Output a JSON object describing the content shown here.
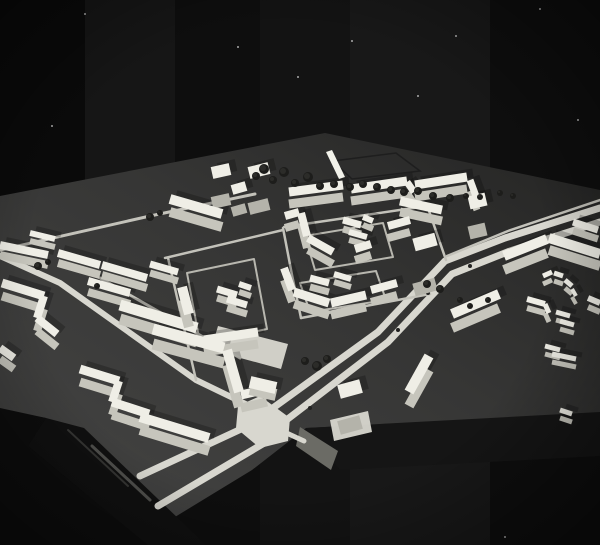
{
  "meta": {
    "alt": "Black-and-white photograph of a white architectural scale model of a residential district (urban planning maquette) on a dark baseboard against a black background"
  },
  "palette": {
    "background": "#0a0a0a",
    "board_light": "#454544",
    "board_mid": "#363635",
    "board_dark": "#242423",
    "board_face": "#151515",
    "board_face_lit": "#6b6b65",
    "roll_dark": "#101010",
    "road": "#d8d7cf",
    "path": "#c3c2ba",
    "loop": "#b8b7af",
    "building_top": "#efeee6",
    "building_face": "#c6c5bc",
    "building_face_tall": "#b4b3aa",
    "sliver": "#f2f2ea",
    "tree": "#1d1d1b",
    "tree_hi": "#3c3c38",
    "field_line": "#1e1e1e",
    "median_dot": "#222221"
  },
  "background": {
    "bands": [
      {
        "x": 0,
        "w": 85,
        "o": 0.0
      },
      {
        "x": 85,
        "w": 90,
        "o": 0.05
      },
      {
        "x": 175,
        "w": 85,
        "o": 0.02
      },
      {
        "x": 260,
        "w": 90,
        "o": 0.04
      },
      {
        "x": 350,
        "w": 140,
        "o": 0.06
      },
      {
        "x": 490,
        "w": 110,
        "o": 0.02
      }
    ],
    "specks": [
      [
        85,
        14
      ],
      [
        75,
        242
      ],
      [
        103,
        296
      ],
      [
        52,
        126
      ],
      [
        298,
        77
      ],
      [
        352,
        41
      ],
      [
        456,
        36
      ],
      [
        540,
        9
      ],
      [
        578,
        120
      ],
      [
        418,
        96
      ],
      [
        238,
        47
      ],
      [
        505,
        537
      ]
    ]
  },
  "board": {
    "outline": [
      [
        0,
        196
      ],
      [
        325,
        133
      ],
      [
        600,
        190
      ],
      [
        600,
        413
      ],
      [
        306,
        428
      ],
      [
        252,
        470
      ],
      [
        170,
        520
      ],
      [
        46,
        418
      ],
      [
        0,
        410
      ]
    ],
    "front_face": [
      [
        306,
        428
      ],
      [
        600,
        412
      ],
      [
        600,
        456
      ],
      [
        340,
        470
      ]
    ],
    "front_face_lit": [
      [
        300,
        427
      ],
      [
        338,
        451
      ],
      [
        331,
        470
      ],
      [
        296,
        446
      ]
    ],
    "corner_dark": [
      [
        0,
        408
      ],
      [
        46,
        418
      ],
      [
        28,
        446
      ],
      [
        148,
        545
      ],
      [
        0,
        545
      ]
    ],
    "roll": [
      [
        46,
        418
      ],
      [
        84,
        428
      ],
      [
        206,
        545
      ],
      [
        148,
        545
      ],
      [
        28,
        446
      ]
    ],
    "roll_highlights": [
      {
        "pts": [
          [
            92,
            446
          ],
          [
            150,
            500
          ]
        ],
        "w": 3,
        "o": 0.55,
        "c": "#83837d"
      },
      {
        "pts": [
          [
            68,
            430
          ],
          [
            128,
            486
          ]
        ],
        "w": 2,
        "o": 0.5,
        "c": "#5a5a55"
      }
    ],
    "field_outline": [
      [
        333,
        161
      ],
      [
        396,
        153
      ],
      [
        420,
        171
      ],
      [
        352,
        179
      ]
    ]
  },
  "roads": {
    "lines": [
      {
        "w": 7,
        "pts": [
          [
            600,
            208
          ],
          [
            505,
            238
          ],
          [
            445,
            261
          ],
          [
            378,
            332
          ],
          [
            266,
            413
          ]
        ]
      },
      {
        "w": 7,
        "pts": [
          [
            600,
            222
          ],
          [
            510,
            251
          ],
          [
            452,
            274
          ],
          [
            388,
            342
          ],
          [
            276,
            428
          ]
        ]
      },
      {
        "w": 7,
        "pts": [
          [
            252,
            424
          ],
          [
            140,
            476
          ]
        ]
      },
      {
        "w": 7,
        "pts": [
          [
            266,
            442
          ],
          [
            158,
            506
          ]
        ]
      },
      {
        "w": 2.5,
        "pts": [
          [
            600,
            200
          ],
          [
            508,
            231
          ],
          [
            447,
            256
          ]
        ]
      },
      {
        "w": 6,
        "pts": [
          [
            258,
            410
          ],
          [
            196,
            380
          ],
          [
            60,
            283
          ],
          [
            0,
            256
          ]
        ]
      },
      {
        "w": 5,
        "pts": [
          [
            280,
            430
          ],
          [
            304,
            441
          ]
        ]
      },
      {
        "w": 3,
        "pts": [
          [
            0,
            250
          ],
          [
            150,
            216
          ],
          [
            255,
            194
          ]
        ]
      },
      {
        "w": 3,
        "pts": [
          [
            100,
            278
          ],
          [
            240,
            358
          ]
        ]
      },
      {
        "w": 2.5,
        "pts": [
          [
            283,
            228
          ],
          [
            292,
            275
          ],
          [
            301,
            318
          ]
        ]
      },
      {
        "w": 2.5,
        "pts": [
          [
            284,
            227
          ],
          [
            420,
            207
          ]
        ]
      },
      {
        "w": 2.5,
        "pts": [
          [
            301,
            318
          ],
          [
            430,
            294
          ]
        ]
      },
      {
        "w": 2.5,
        "pts": [
          [
            428,
            208
          ],
          [
            446,
            260
          ]
        ]
      },
      {
        "w": 2.5,
        "pts": [
          [
            168,
            258
          ],
          [
            196,
            380
          ]
        ]
      },
      {
        "w": 2.5,
        "pts": [
          [
            165,
            258
          ],
          [
            283,
            230
          ]
        ]
      }
    ],
    "intersection": [
      [
        238,
        406
      ],
      [
        260,
        396
      ],
      [
        290,
        418
      ],
      [
        288,
        441
      ],
      [
        260,
        448
      ],
      [
        236,
        428
      ]
    ],
    "plazas": [
      [
        [
          218,
          326
        ],
        [
          288,
          344
        ],
        [
          281,
          369
        ],
        [
          211,
          350
        ]
      ],
      [
        [
          330,
          420
        ],
        [
          368,
          411
        ],
        [
          372,
          432
        ],
        [
          334,
          441
        ]
      ]
    ],
    "loops": [
      [
        [
          305,
          236
        ],
        [
          383,
          223
        ],
        [
          393,
          257
        ],
        [
          315,
          270
        ]
      ],
      [
        [
          300,
          283
        ],
        [
          376,
          271
        ],
        [
          386,
          300
        ],
        [
          310,
          312
        ]
      ],
      [
        [
          187,
          273
        ],
        [
          254,
          259
        ],
        [
          267,
          329
        ],
        [
          200,
          343
        ]
      ]
    ],
    "median_dots": [
      [
        470,
        266
      ],
      [
        428,
        293
      ],
      [
        398,
        330
      ],
      [
        352,
        382
      ],
      [
        310,
        408
      ]
    ]
  },
  "buildings": {
    "shadow": {
      "dx": 6,
      "dy": -4,
      "o": 0.22
    },
    "bars": [
      [
        212,
        203,
        230,
        199,
        12,
        30
      ],
      [
        249,
        209,
        269,
        204,
        12,
        36
      ],
      [
        232,
        212,
        246,
        208,
        10,
        22
      ],
      [
        289,
        204,
        343,
        197,
        9,
        12
      ],
      [
        351,
        201,
        407,
        193,
        9,
        12
      ],
      [
        407,
        193,
        414,
        203,
        7,
        11
      ],
      [
        415,
        197,
        467,
        189,
        9,
        12
      ],
      [
        470,
        191,
        477,
        210,
        7,
        11
      ],
      [
        400,
        212,
        442,
        221,
        9,
        11
      ],
      [
        469,
        233,
        486,
        229,
        13,
        30
      ],
      [
        549,
        250,
        600,
        266,
        10,
        12
      ],
      [
        573,
        231,
        598,
        239,
        7,
        9
      ],
      [
        414,
        290,
        436,
        284,
        13,
        45
      ],
      [
        388,
        238,
        410,
        232,
        8,
        12
      ],
      [
        170,
        212,
        222,
        227,
        10,
        13
      ],
      [
        58,
        263,
        100,
        275,
        8,
        10
      ],
      [
        102,
        275,
        147,
        288,
        8,
        10
      ],
      [
        0,
        255,
        48,
        265,
        8,
        10
      ],
      [
        30,
        241,
        55,
        247,
        6,
        8
      ],
      [
        88,
        292,
        130,
        304,
        8,
        11
      ],
      [
        120,
        319,
        197,
        342,
        11,
        14
      ],
      [
        2,
        296,
        44,
        309,
        9,
        13
      ],
      [
        44,
        309,
        37,
        331,
        8,
        13
      ],
      [
        37,
        331,
        57,
        347,
        8,
        13
      ],
      [
        0,
        359,
        14,
        369,
        8,
        11
      ],
      [
        80,
        382,
        119,
        394,
        9,
        13
      ],
      [
        119,
        394,
        112,
        415,
        8,
        13
      ],
      [
        112,
        415,
        149,
        427,
        9,
        13
      ],
      [
        140,
        430,
        209,
        451,
        10,
        13
      ],
      [
        182,
        300,
        189,
        327,
        10,
        13
      ],
      [
        217,
        298,
        237,
        304,
        7,
        9
      ],
      [
        239,
        292,
        251,
        296,
        6,
        8
      ],
      [
        227,
        308,
        247,
        314,
        7,
        9
      ],
      [
        204,
        352,
        258,
        344,
        9,
        12
      ],
      [
        150,
        273,
        178,
        281,
        7,
        9
      ],
      [
        153,
        344,
        224,
        363,
        11,
        15
      ],
      [
        227,
        365,
        239,
        407,
        10,
        15
      ],
      [
        241,
        408,
        267,
        402,
        9,
        13
      ],
      [
        250,
        389,
        276,
        395,
        12,
        7
      ],
      [
        285,
        228,
        299,
        224,
        8,
        12
      ],
      [
        301,
        225,
        307,
        248,
        8,
        12
      ],
      [
        308,
        250,
        333,
        264,
        8,
        12
      ],
      [
        343,
        229,
        361,
        234,
        7,
        9
      ],
      [
        363,
        225,
        373,
        229,
        6,
        8
      ],
      [
        349,
        240,
        367,
        245,
        6,
        8
      ],
      [
        284,
        280,
        292,
        302,
        8,
        12
      ],
      [
        294,
        304,
        329,
        315,
        9,
        12
      ],
      [
        331,
        315,
        366,
        307,
        9,
        12
      ],
      [
        310,
        287,
        329,
        292,
        7,
        9
      ],
      [
        334,
        282,
        351,
        287,
        6,
        8
      ],
      [
        371,
        302,
        397,
        295,
        8,
        12
      ],
      [
        355,
        260,
        371,
        255,
        8,
        11
      ],
      [
        504,
        270,
        547,
        253,
        10,
        14
      ],
      [
        452,
        328,
        499,
        308,
        10,
        14
      ],
      [
        409,
        406,
        429,
        370,
        10,
        14
      ],
      [
        339,
        428,
        361,
        422,
        14,
        36
      ],
      [
        543,
        284,
        552,
        280,
        5,
        8
      ],
      [
        554,
        281,
        563,
        284,
        5,
        8
      ],
      [
        565,
        288,
        572,
        294,
        5,
        8
      ],
      [
        572,
        297,
        576,
        304,
        4,
        8
      ],
      [
        527,
        308,
        545,
        313,
        6,
        9
      ],
      [
        545,
        313,
        549,
        322,
        5,
        9
      ],
      [
        556,
        320,
        570,
        324,
        5,
        8
      ],
      [
        560,
        329,
        574,
        333,
        5,
        8
      ],
      [
        545,
        354,
        560,
        358,
        5,
        8
      ],
      [
        552,
        362,
        576,
        367,
        5,
        8
      ],
      [
        588,
        307,
        600,
        312,
        6,
        9
      ],
      [
        560,
        418,
        572,
        422,
        5,
        8
      ]
    ],
    "slivers": [
      [
        [
          326,
          152
        ],
        [
          332,
          150
        ],
        [
          345,
          177
        ],
        [
          339,
          179
        ]
      ]
    ]
  },
  "trees": [
    [
      256,
      176,
      4
    ],
    [
      264,
      169,
      5
    ],
    [
      273,
      180,
      4
    ],
    [
      284,
      172,
      5
    ],
    [
      295,
      183,
      4
    ],
    [
      308,
      177,
      5
    ],
    [
      320,
      186,
      4
    ],
    [
      334,
      184,
      4
    ],
    [
      350,
      187,
      4
    ],
    [
      363,
      184,
      4
    ],
    [
      377,
      187,
      4
    ],
    [
      391,
      190,
      4
    ],
    [
      404,
      192,
      4
    ],
    [
      418,
      191,
      4
    ],
    [
      433,
      196,
      4
    ],
    [
      450,
      198,
      4
    ],
    [
      466,
      196,
      3
    ],
    [
      480,
      197,
      3
    ],
    [
      500,
      193,
      3
    ],
    [
      513,
      196,
      3
    ],
    [
      38,
      266,
      4
    ],
    [
      48,
      262,
      3
    ],
    [
      150,
      217,
      4
    ],
    [
      160,
      213,
      3
    ],
    [
      97,
      286,
      3
    ],
    [
      305,
      361,
      4
    ],
    [
      317,
      366,
      5
    ],
    [
      327,
      359,
      4
    ],
    [
      427,
      284,
      4
    ],
    [
      440,
      289,
      4
    ],
    [
      460,
      300,
      3
    ],
    [
      470,
      306,
      3
    ],
    [
      488,
      300,
      3
    ]
  ]
}
